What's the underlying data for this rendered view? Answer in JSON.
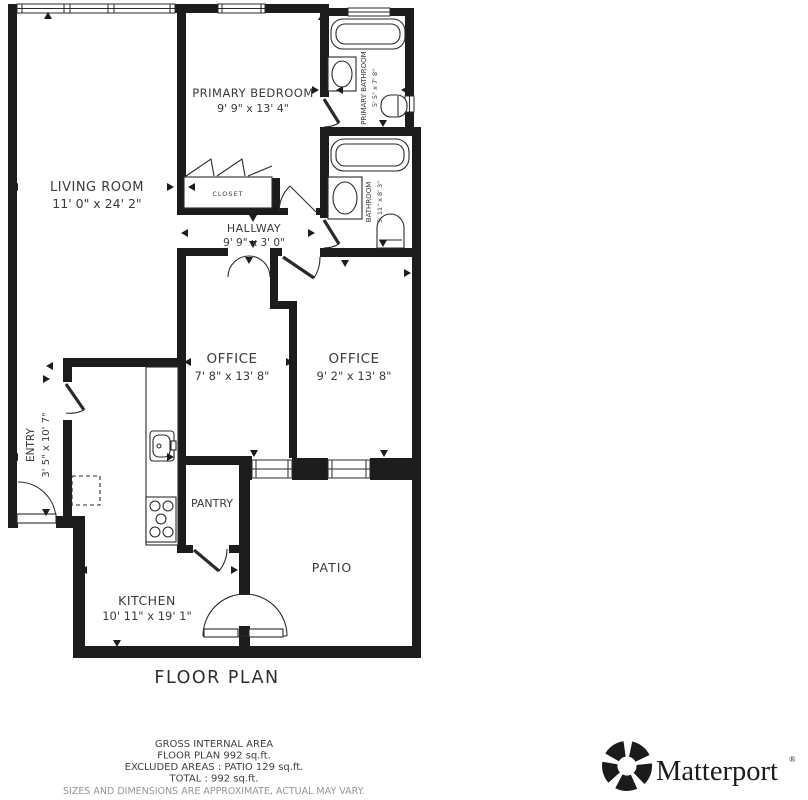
{
  "plan": {
    "title": "FLOOR PLAN",
    "rooms": {
      "living_room": {
        "name": "LIVING ROOM",
        "dims": "11' 0\" x 24' 2\""
      },
      "primary_bedroom": {
        "name": "PRIMARY BEDROOM",
        "dims": "9' 9\" x 13' 4\""
      },
      "primary_bathroom": {
        "name": "PRIMARY BATHROOM",
        "dims": "5' 5\" x 7' 8\""
      },
      "bathroom": {
        "name": "BATHROOM",
        "dims": "5' 11\" x 8' 3\""
      },
      "hallway": {
        "name": "HALLWAY",
        "dims": "9' 9\" x 3' 0\""
      },
      "closet": {
        "name": "CLOSET"
      },
      "office_left": {
        "name": "OFFICE",
        "dims": "7' 8\" x 13' 8\""
      },
      "office_right": {
        "name": "OFFICE",
        "dims": "9' 2\" x 13' 8\""
      },
      "entry": {
        "name": "ENTRY",
        "dims": "3' 5\" x 10' 7\""
      },
      "pantry": {
        "name": "PANTRY"
      },
      "kitchen": {
        "name": "KITCHEN",
        "dims": "10' 11\" x 19' 1\""
      },
      "patio": {
        "name": "PATIO"
      }
    }
  },
  "footer": {
    "line1": "GROSS INTERNAL AREA",
    "line2": "FLOOR PLAN 992 sq.ft.",
    "line3": "EXCLUDED AREAS :  PATIO 129 sq.ft.",
    "line4": "TOTAL :  992 sq.ft.",
    "disclaimer": "SIZES AND DIMENSIONS ARE APPROXIMATE, ACTUAL MAY VARY."
  },
  "brand": {
    "name": "Matterport",
    "registered": "®"
  },
  "colors": {
    "wall": "#1c1c1c",
    "fixture": "#2a2a2a",
    "label": "#3a3a3a",
    "title": "#2e2e2e",
    "footer_text": "#3f3f3f",
    "muted": "#969696",
    "logo": "#1b1b1b",
    "background": "#ffffff"
  }
}
